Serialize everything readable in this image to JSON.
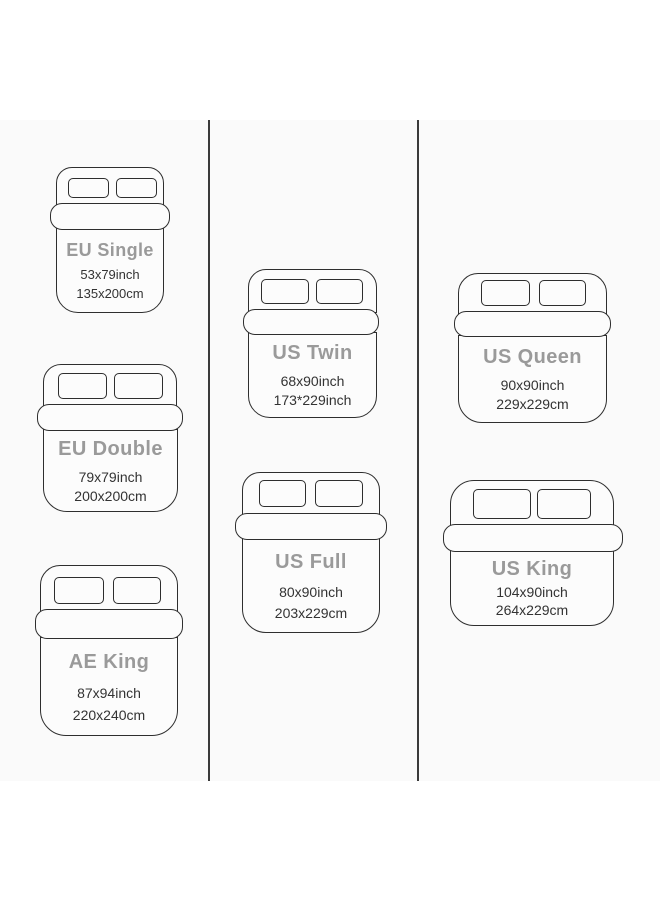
{
  "colors": {
    "outline": "#2e2e2e",
    "bed_name": "#9a9a9a",
    "bed_dim": "#333333",
    "divider": "#3a3a3a",
    "band_bg": "#fafafa",
    "bed_fill": "#fcfcfc"
  },
  "beds": [
    {
      "name": "EU Single",
      "inches": "53x79inch",
      "metric": "135x200cm"
    },
    {
      "name": "EU Double",
      "inches": "79x79inch",
      "metric": "200x200cm"
    },
    {
      "name": "AE King",
      "inches": "87x94inch",
      "metric": "220x240cm"
    },
    {
      "name": "US Twin",
      "inches": "68x90inch",
      "metric": "173*229inch"
    },
    {
      "name": "US Full",
      "inches": "80x90inch",
      "metric": "203x229cm"
    },
    {
      "name": "US Queen",
      "inches": "90x90inch",
      "metric": "229x229cm"
    },
    {
      "name": "US King",
      "inches": "104x90inch",
      "metric": "264x229cm"
    }
  ]
}
